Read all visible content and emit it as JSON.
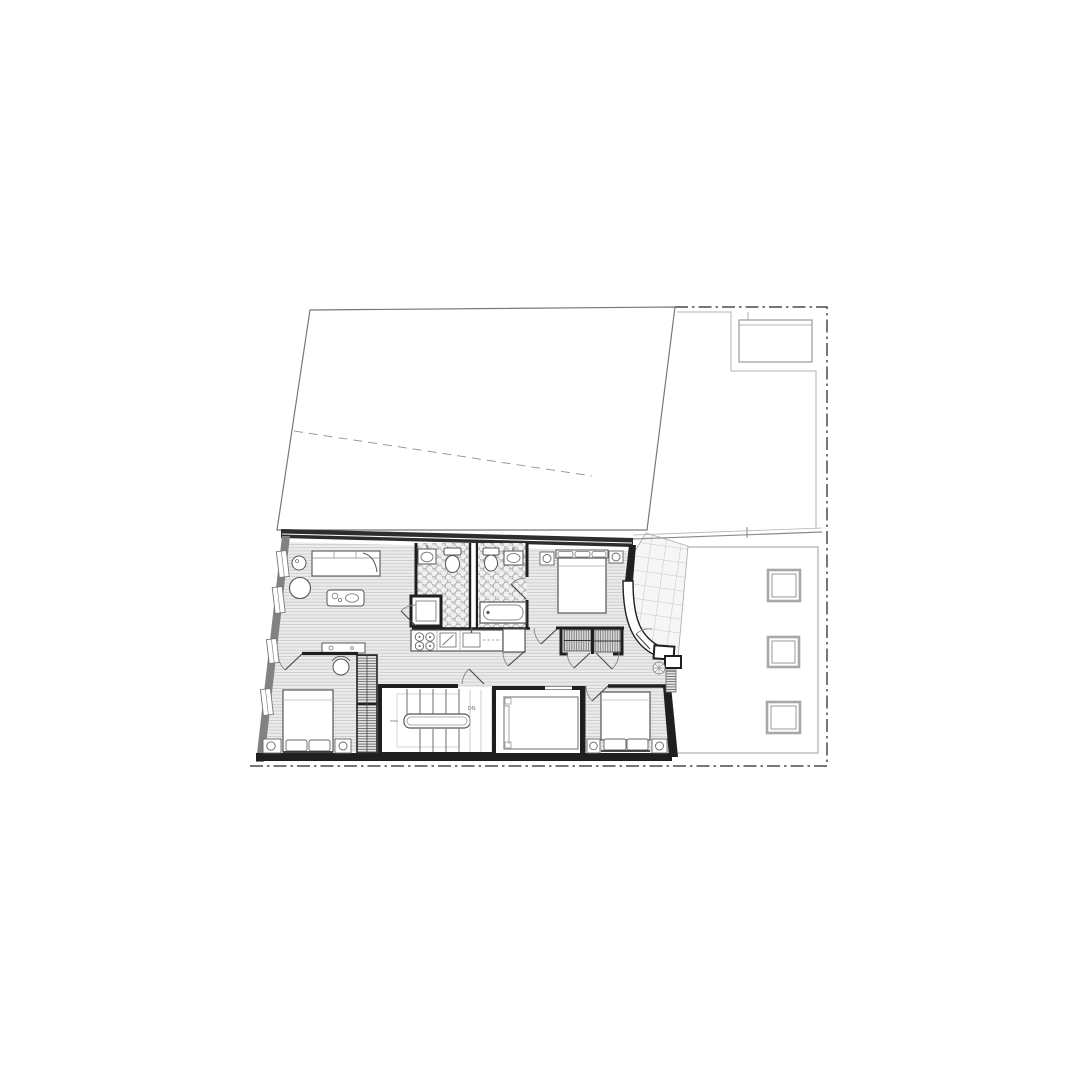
{
  "drawing": {
    "kind": "architectural floor plan (black-and-white line drawing, no title block)",
    "background": "#ffffff",
    "palette": {
      "wall_black": "#1f1f1f",
      "wall_grey": "#828282",
      "line_dark": "#4a4a4a",
      "line_mid": "#8a8a8a",
      "line_light": "#bdbdbd",
      "floor_fill": "#ebebeb",
      "floor_stripe": "#cdcdcd",
      "hex_tile_fill": "#dedede",
      "white": "#ffffff"
    },
    "labels": {
      "stairs_direction": "DN"
    },
    "site": {
      "boundary": "dash-dot property line around top-right, right and bottom edges",
      "upper_area": "large empty roof / lower-roof trapezoid with dashed ridge line",
      "roof_terrace_top_right": "small rectangular roof light inside offset boundary",
      "right_terrace": "neighbouring flat roof with three square skylights",
      "entry_court": "tiled wedge court at the entrance with curved wall, steps and plant"
    },
    "rooms": [
      {
        "name": "lounge-bedroom",
        "features": [
          "sofa-daybed",
          "round-stool",
          "round-table",
          "coffee-table",
          "desk",
          "armchair"
        ]
      },
      {
        "name": "bathroom-1",
        "features": [
          "wash-basin",
          "toilet",
          "shower-cubicle",
          "penny-round-tile-floor"
        ]
      },
      {
        "name": "bathroom-2",
        "features": [
          "toilet",
          "wash-basin",
          "bathtub",
          "penny-round-tile-floor"
        ]
      },
      {
        "name": "master-bedroom",
        "features": [
          "double-bed",
          "two-nightstands-with-lamps"
        ]
      },
      {
        "name": "kitchen",
        "features": [
          "four-burner-hob",
          "worktop",
          "sink",
          "tall-cabinet"
        ]
      },
      {
        "name": "hallway",
        "features": [
          "door-swings",
          "timber-strip-floor"
        ]
      },
      {
        "name": "closets",
        "features": [
          "two-wardrobes-with-hanging-rails"
        ]
      },
      {
        "name": "bedroom-2",
        "features": [
          "double-bed",
          "nightstands",
          "wardrobe-wall"
        ]
      },
      {
        "name": "stairwell",
        "features": [
          "two-flights",
          "central-handrail",
          "down-label"
        ]
      },
      {
        "name": "elevator",
        "features": [
          "shaft-walls",
          "car-outline"
        ]
      },
      {
        "name": "bedroom-3",
        "features": [
          "double-bed",
          "nightstands"
        ]
      }
    ]
  }
}
